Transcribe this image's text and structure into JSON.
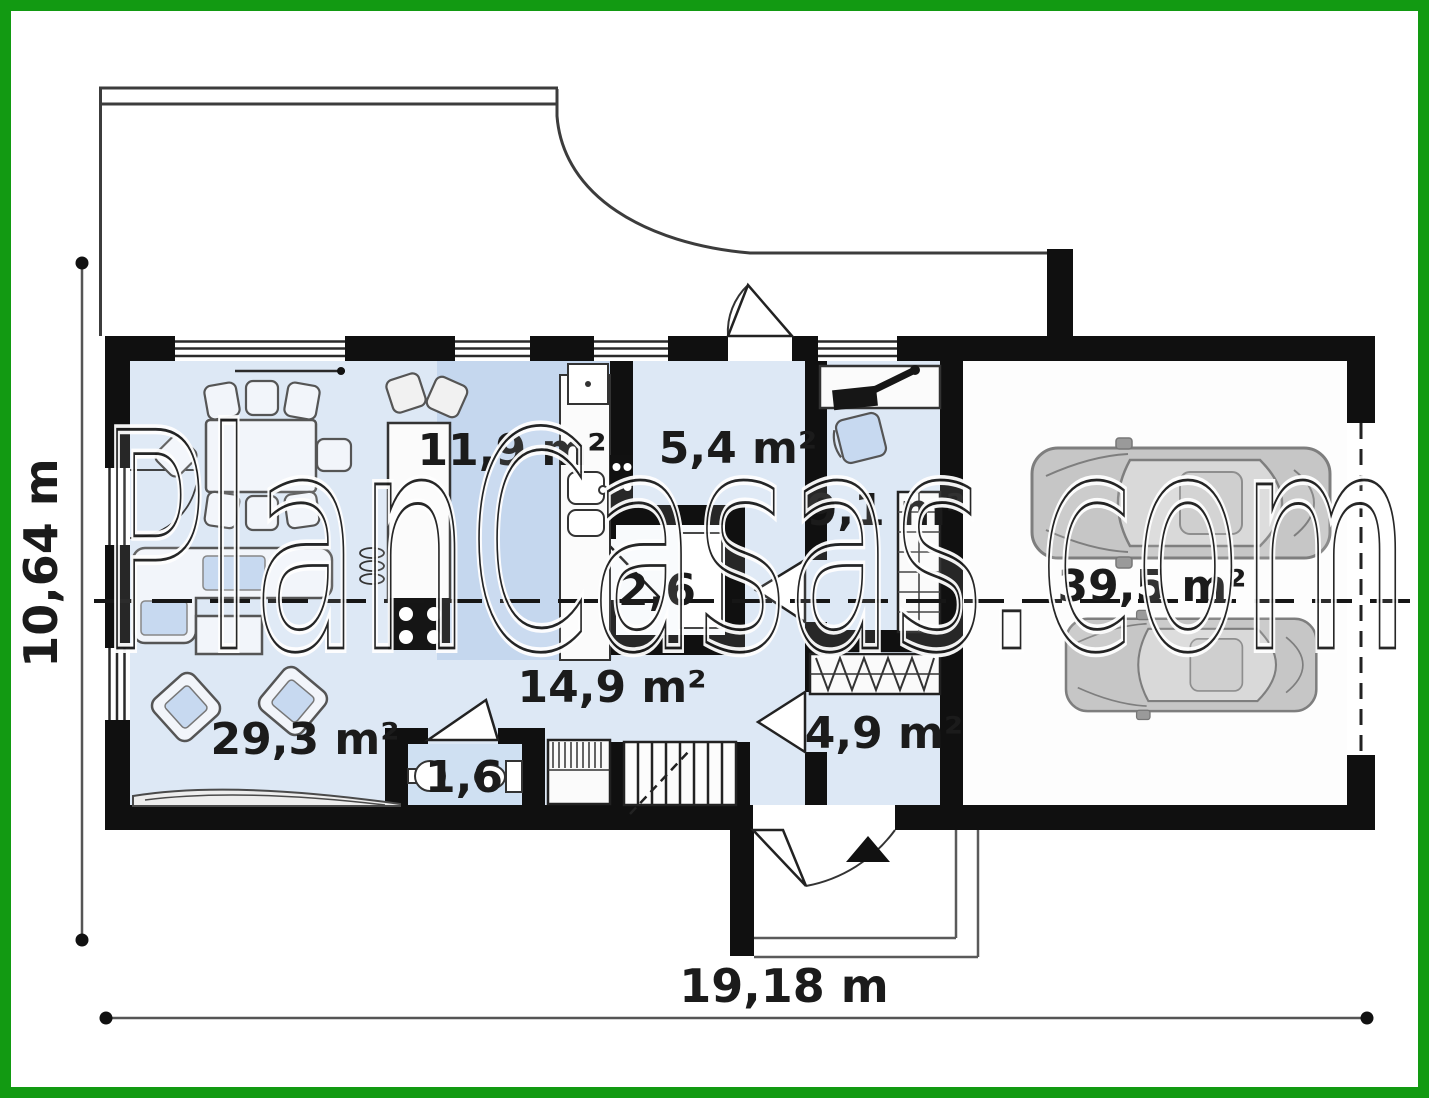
{
  "watermark": {
    "text": "PlanCasas.com"
  },
  "dimensions": {
    "vertical": "10,64 m",
    "horizontal": "19,18 m"
  },
  "rooms": {
    "living": "29,3 m²",
    "kitchen": "11,9 m²",
    "hall": "5,4 m²",
    "office": "9,1 m²",
    "pantry": "2,6",
    "corridor": "14,9 m²",
    "wc": "1,6",
    "entry": "4,9 m²",
    "garage": "39,5 m²"
  },
  "colors": {
    "border_green": "#129a12",
    "wall": "#101010",
    "floor_light": "#dde8f5",
    "floor_accent": "#c5d7ee",
    "furniture_fill": "#f2f5fa",
    "cushion_blue": "#c7d9f0",
    "car_gray": "#c6c6c6"
  }
}
